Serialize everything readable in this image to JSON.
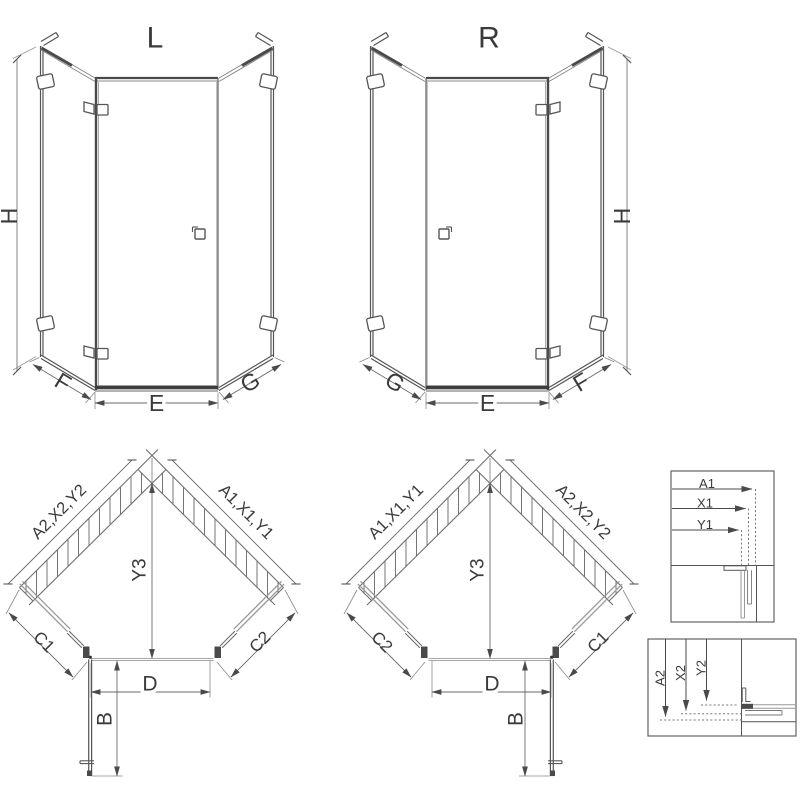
{
  "views": {
    "front_left": {
      "title": "L",
      "height_label": "H",
      "left_bottom_label": "F",
      "bottom_label": "E",
      "right_bottom_label": "G"
    },
    "front_right": {
      "title": "R",
      "height_label": "H",
      "left_bottom_label": "G",
      "bottom_label": "E",
      "right_bottom_label": "F"
    },
    "plan_left": {
      "left_wall_label": "A2,X2,Y2",
      "right_wall_label": "A1,X1,Y1",
      "center_label": "Y3",
      "left_glass_label": "C1",
      "right_glass_label": "C2",
      "door_width_label": "D",
      "door_swing_label": "B"
    },
    "plan_right": {
      "left_wall_label": "A1,X1,Y1",
      "right_wall_label": "A2,X2,Y2",
      "center_label": "Y3",
      "left_glass_label": "C2",
      "right_glass_label": "C1",
      "door_width_label": "D",
      "door_swing_label": "B"
    },
    "detail_top": {
      "labels": [
        "A1",
        "X1",
        "Y1"
      ]
    },
    "detail_bottom": {
      "labels": [
        "A2",
        "X2",
        "Y2"
      ]
    }
  },
  "colors": {
    "line": "#4a4a4a",
    "medium": "#6a6a6a",
    "thin": "#9a9a9a",
    "hatch": "#707070",
    "dark_fill": "#3d3d3d",
    "background": "#ffffff"
  }
}
